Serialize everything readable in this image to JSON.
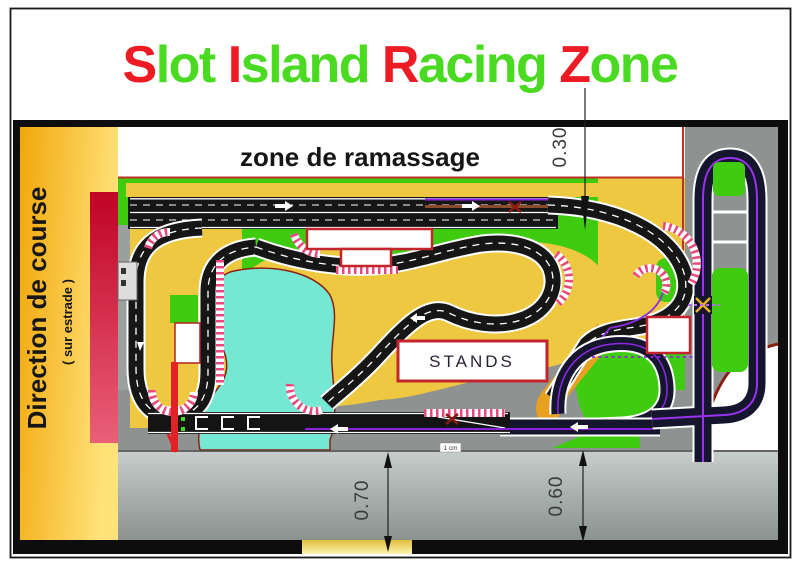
{
  "title": {
    "text": "Slot Island Racing Zone",
    "segments": [
      {
        "text": "S",
        "color": "#ed1c24"
      },
      {
        "text": "lot ",
        "color": "#4ada22"
      },
      {
        "text": "I",
        "color": "#ed1c24"
      },
      {
        "text": "sland ",
        "color": "#4ada22"
      },
      {
        "text": "R",
        "color": "#ed1c24"
      },
      {
        "text": "acing ",
        "color": "#4ada22"
      },
      {
        "text": "Z",
        "color": "#ed1c24"
      },
      {
        "text": "one",
        "color": "#4ada22"
      }
    ]
  },
  "direction_bar": {
    "label": "Direction de course",
    "sublabel": "( sur estrade )"
  },
  "plan": {
    "pickup_zone_label": "zone de ramassage",
    "stands_label": "STANDS",
    "scale_badge": "1 cm"
  },
  "measurements": {
    "top_width": "0.30",
    "bottom_left_height": "0.70",
    "bottom_right_height": "0.60"
  },
  "colors": {
    "title_red": "#ed1c24",
    "title_green": "#4ada22",
    "grass": "#3ecb10",
    "sand": "#eec840",
    "water": "#74e8d3",
    "track_black": "#161616",
    "secondary_track_navy": "#15152e",
    "purple_line": "#8822dd",
    "curb_pink": "#e8487e",
    "direction_bar_orange": "#f2a70b",
    "stand_bar_red": "#c00325",
    "start_post_red": "#e32227",
    "boundary_dark_red": "#8c1f14",
    "box_border_red": "#c2262c",
    "surround_gray": "#8e9291"
  }
}
